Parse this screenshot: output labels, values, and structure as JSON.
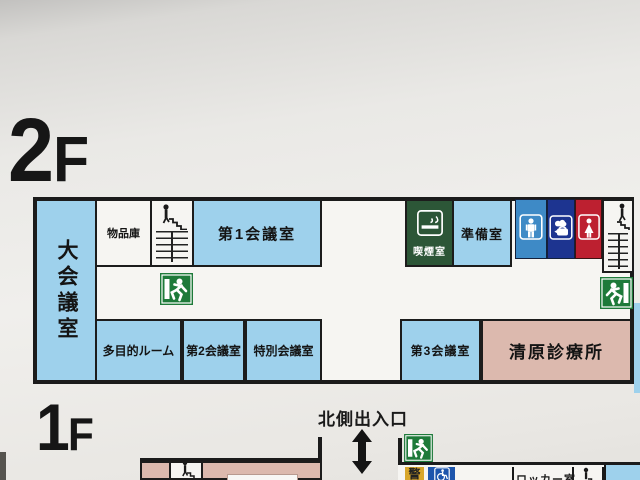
{
  "sign": {
    "type": "building-floor-guide",
    "colors": {
      "room_blue": "#9ed1ec",
      "room_pink": "#dcb9ae",
      "smoking_green": "#2c5637",
      "exit_green": "#1e7a3a",
      "wc_men_blue": "#3e8ac6",
      "kitchenette_navy": "#1d3490",
      "wc_women_red": "#bd2030",
      "security_yellow": "#d8a62b",
      "wheelchair_blue": "#1d55ac",
      "wall_black": "#1b1b1b"
    },
    "icons": {
      "exit": "emergency-exit-running-man",
      "stairs": "person-on-stairs",
      "toilet_men": "man-pictogram",
      "kitchenette": "kettle-with-steam",
      "toilet_women": "woman-pictogram",
      "smoking": "cigarette-with-smoke",
      "wheelchair": "wheelchair-access",
      "entrance_arrow": "double-headed-vertical-arrow"
    }
  },
  "floor2": {
    "number": "2",
    "letter": "F",
    "rooms": {
      "large_meeting_room": "大会議室",
      "storage": "物品庫",
      "meeting_room_1": "第1会議室",
      "smoking_room": "喫煙室",
      "prep_room": "準備室",
      "multipurpose_room": "多目的ルーム",
      "meeting_room_2": "第2会議室",
      "special_meeting_room": "特別会議室",
      "meeting_room_3": "第3会議室",
      "clinic": "清原診療所"
    }
  },
  "floor1": {
    "number": "1",
    "letter": "F",
    "north_entrance_label": "北側出入口",
    "rooms": {
      "security": "警",
      "locker_room": "ロッカー室"
    }
  }
}
